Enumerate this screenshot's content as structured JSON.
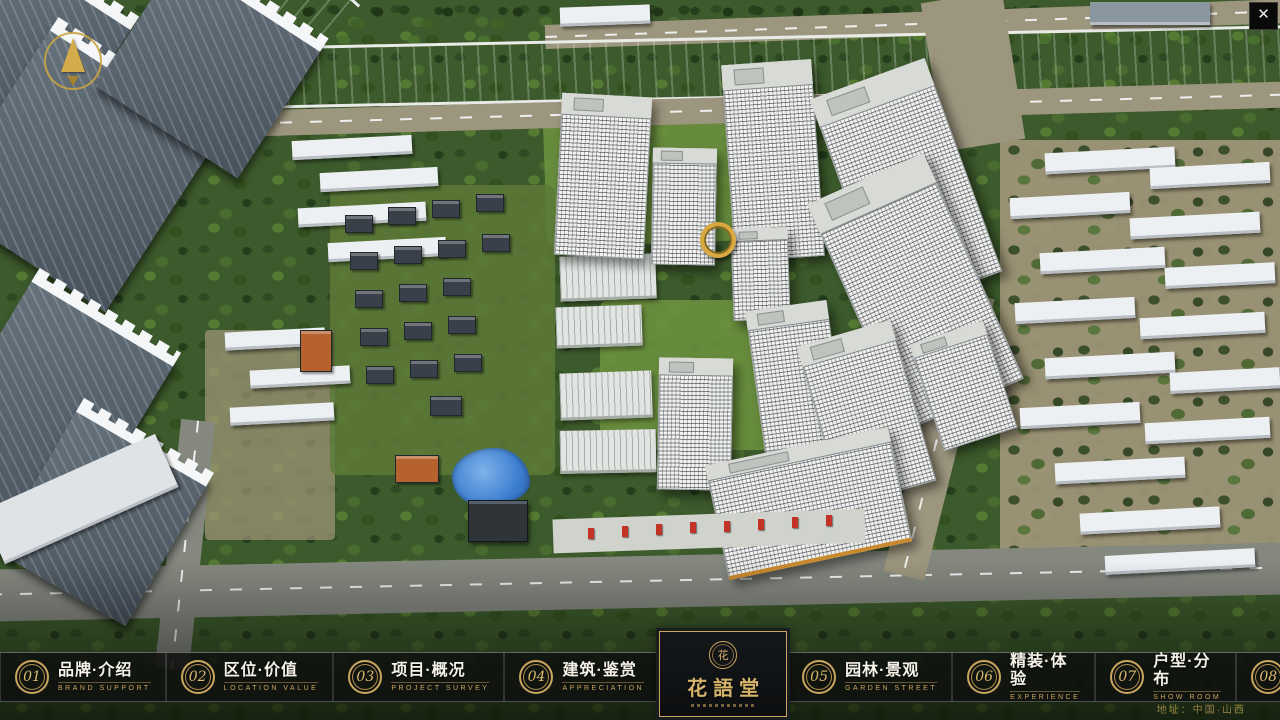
{
  "window": {
    "close_icon": "✕"
  },
  "icons": {
    "compass": "north-arrow",
    "seal_glyph": "花"
  },
  "logo": {
    "title": "花語堂"
  },
  "nav": {
    "items": [
      {
        "number": "01",
        "label": "品牌·介绍",
        "sublabel": "BRAND SUPPORT"
      },
      {
        "number": "02",
        "label": "区位·价值",
        "sublabel": "LOCATION VALUE"
      },
      {
        "number": "03",
        "label": "项目·概况",
        "sublabel": "PROJECT SURVEY"
      },
      {
        "number": "04",
        "label": "建筑·鉴赏",
        "sublabel": "APPRECIATION"
      },
      {
        "number": "05",
        "label": "园林·景观",
        "sublabel": "GARDEN STREET"
      },
      {
        "number": "06",
        "label": "精装·体验",
        "sublabel": "EXPERIENCE"
      },
      {
        "number": "07",
        "label": "户型·分布",
        "sublabel": "SHOW ROOM"
      },
      {
        "number": "08",
        "label": "一房·一景",
        "sublabel": "COMMUNITY"
      }
    ]
  },
  "footer": {
    "address": "地址：中国·山西"
  },
  "colors": {
    "accent_gold": "#C9A35F",
    "bar_background": "rgba(14,16,14,0.84)",
    "river_blue": "#2257C4",
    "foliage_green": "#3C5A2C"
  }
}
